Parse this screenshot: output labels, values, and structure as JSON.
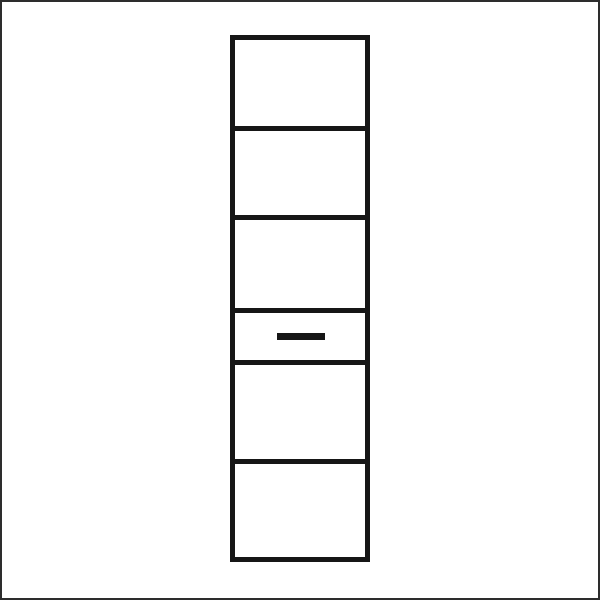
{
  "canvas": {
    "width": 600,
    "height": 600,
    "background": "#ffffff",
    "frame_color": "#2d2d2d",
    "frame_thickness": 2
  },
  "diagram": {
    "type": "furniture-line-drawing",
    "description": "Tall narrow cabinet / shelf unit outline divided into six compartments by horizontal dividers; the fourth compartment from the top is a shallow drawer with a horizontal handle bar",
    "line_color": "#161616",
    "stroke_width": 5,
    "cabinet": {
      "x": 230,
      "y": 35,
      "width": 140,
      "height": 527
    },
    "dividers_y": [
      126,
      215,
      308,
      360,
      459
    ],
    "section_count": 6,
    "drawer": {
      "section_index": 4,
      "handle": {
        "x": 277,
        "y": 333,
        "width": 48,
        "height": 7
      }
    }
  }
}
